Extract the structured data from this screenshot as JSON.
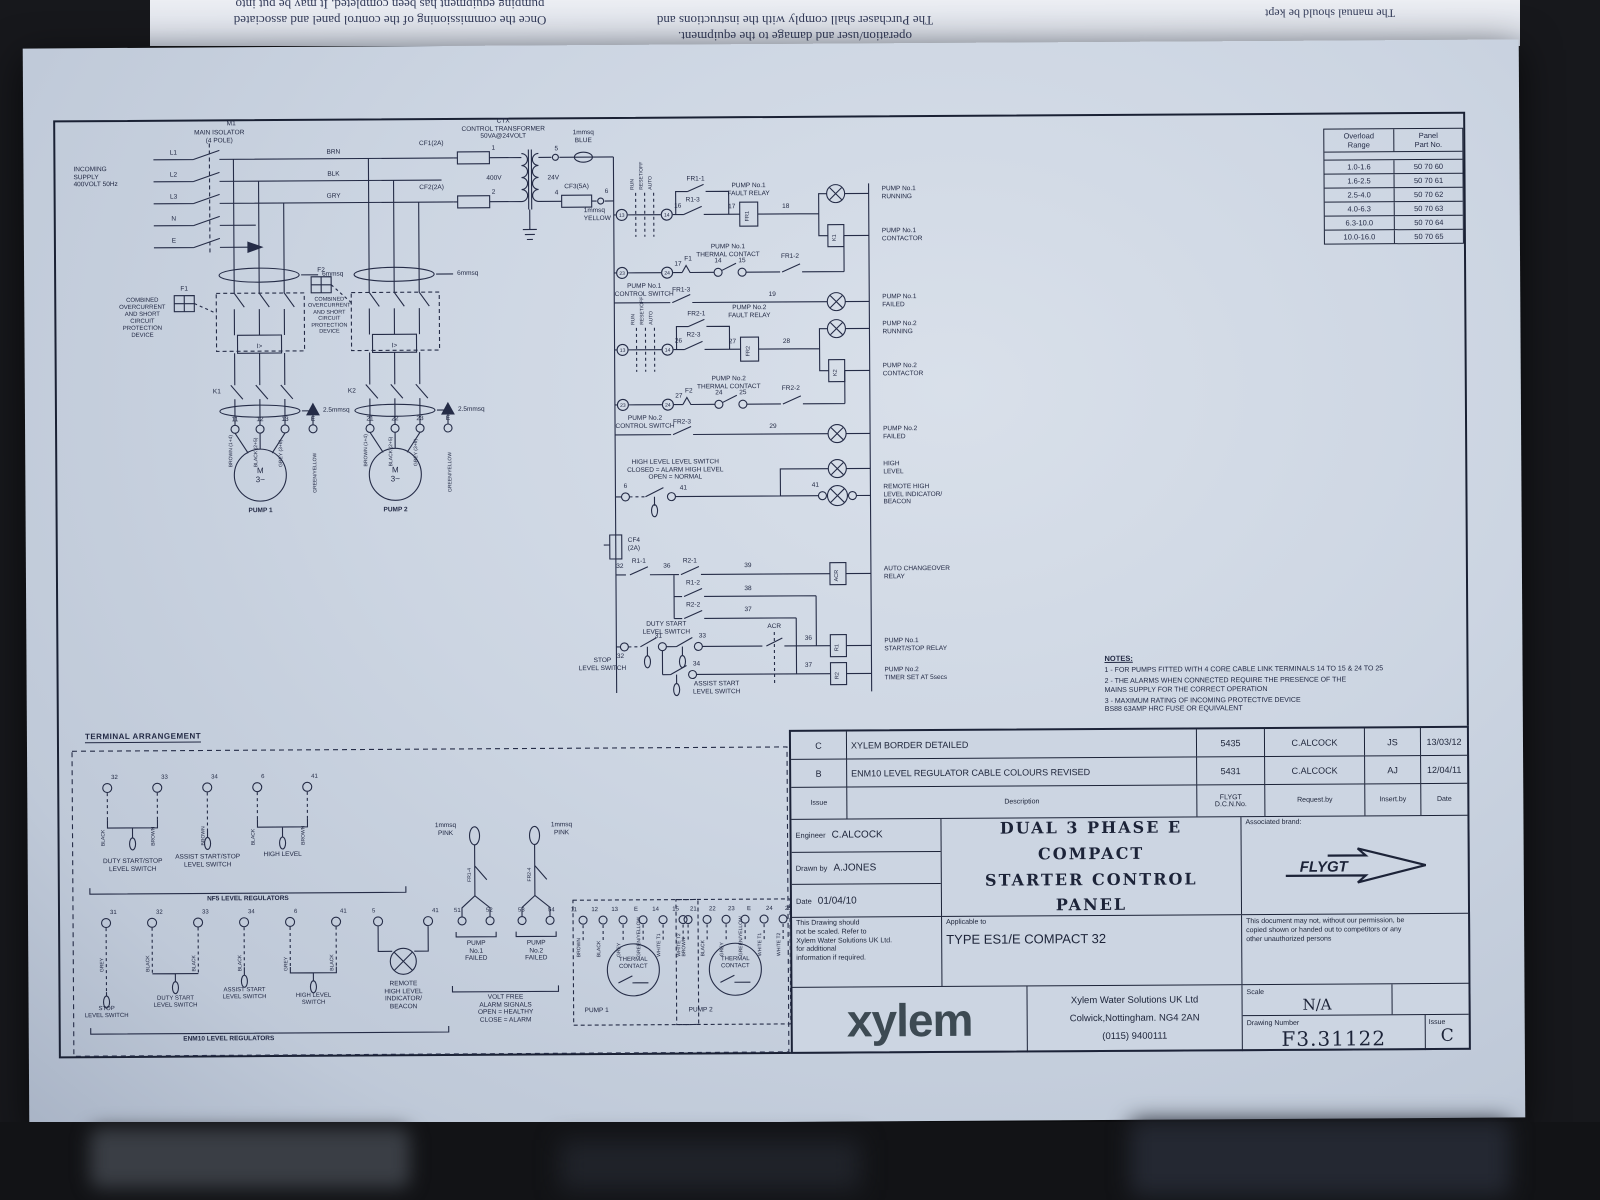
{
  "photo": {
    "flip_l1": "Once the commissioning of the control panel and associated",
    "flip_l2": "pumping equipment has been completed. It may be put into",
    "flip_c1": "operation/user and damage to the equipment.",
    "flip_c2": "The Purchaser shall comply with the instructions and",
    "flip_r1": "The manual should be kept"
  },
  "sch": {
    "m1": "M1",
    "iso": "MAIN ISOLATOR\n(4 POLE)",
    "incoming": "INCOMING\nSUPPLY\n400VOLT 50Hz",
    "l1": "L1",
    "l2": "L2",
    "l3": "L3",
    "n": "N",
    "e": "E",
    "brn": "BRN",
    "blk": "BLK",
    "gry": "GRY",
    "c6": "6mmsq",
    "c25": "2.5mmsq",
    "prot": "COMBINED\nOVERCURRENT\nAND SHORT\nCIRCUIT\nPROTECTION\nDEVICE",
    "f1": "F1",
    "f2": "F2",
    "isym": "I>",
    "k1": "K1",
    "k2": "K2",
    "motor": "M\n3~",
    "pump1": "PUMP 1",
    "pump2": "PUMP 2",
    "ctx": "CTX\nCONTROL TRANSFORMER\n50VA@24VOLT",
    "cf1": "CF1(2A)",
    "cf2": "CF2(2A)",
    "cf3": "CF3(5A)",
    "cf4": "CF4\n(2A)",
    "v400": "400V",
    "v24": "24V",
    "blue": "1mmsq\nBLUE",
    "yellow": "1mmsq\nYELLOW",
    "pink": "1mmsq\nPINK",
    "run": "RUN",
    "reset": "RESET/OFF",
    "auto": "AUTO",
    "p1ctrl": "PUMP No.1\nCONTROL SWITCH",
    "p2ctrl": "PUMP No.2\nCONTROL SWITCH",
    "fr11": "FR1-1",
    "fr12": "FR1-2",
    "fr13": "FR1-3",
    "fr14": "FR1-4",
    "fr21": "FR2-1",
    "fr22": "FR2-2",
    "fr23": "FR2-3",
    "fr24": "FR2-4",
    "r11": "R1-1",
    "r12": "R1-2",
    "r13": "R1-3",
    "r21": "R2-1",
    "r22": "R2-2",
    "r23": "R2-3",
    "fr1": "FR1",
    "fr2": "FR2",
    "acr": "ACR",
    "r1": "R1",
    "r2": "R2",
    "p1fault": "PUMP No.1\nFAULT RELAY",
    "p2fault": "PUMP No.2\nFAULT RELAY",
    "p1therm": "PUMP No.1\nTHERMAL CONTACT",
    "p2therm": "PUMP No.2\nTHERMAL CONTACT",
    "hlsw": "HIGH LEVEL LEVEL SWITCH\nCLOSED = ALARM HIGH LEVEL\nOPEN = NORMAL",
    "stopls": "STOP\nLEVEL SWITCH",
    "dutyls": "DUTY START\nLEVEL SWITCH",
    "assistls": "ASSIST START\nLEVEL SWITCH",
    "o_p1run": "PUMP No.1\nRUNNING",
    "o_p1cont": "PUMP No.1\nCONTACTOR",
    "o_p1fail": "PUMP No.1\nFAILED",
    "o_p2run": "PUMP No.2\nRUNNING",
    "o_p2cont": "PUMP No.2\nCONTACTOR",
    "o_p2fail": "PUMP No.2\nFAILED",
    "o_hl": "HIGH\nLEVEL",
    "o_remote": "REMOTE HIGH\nLEVEL INDICATOR/\nBEACON",
    "o_acr": "AUTO CHANGEOVER\nRELAY",
    "o_r1": "PUMP No.1\nSTART/STOP RELAY",
    "o_r2": "PUMP No.2\nTIMER SET AT 5secs",
    "t": {
      "1": "1",
      "2": "2",
      "4": "4",
      "5": "5",
      "6": "6",
      "11": "11",
      "12": "12",
      "13": "13",
      "14": "14",
      "15": "15",
      "16": "16",
      "17": "17",
      "18": "18",
      "19": "19",
      "21": "21",
      "22": "22",
      "23": "23",
      "24": "24",
      "25": "25",
      "26": "26",
      "27": "27",
      "28": "28",
      "29": "29",
      "31": "31",
      "32": "32",
      "33": "33",
      "34": "34",
      "36": "36",
      "37": "37",
      "38": "38",
      "39": "39",
      "41": "41",
      "51": "51",
      "52": "52",
      "53": "53",
      "54": "54",
      "E": "E"
    },
    "col": {
      "black": "BLACK",
      "brown": "BROWN",
      "grey": "GREY",
      "grnyel": "GREEN/YELLOW",
      "wt1": "WHITE T1",
      "wt2": "WHITE T2",
      "brown14": "BROWN (1+4)",
      "black25": "BLACK (2+5)",
      "grey36": "GREY (3+6)"
    }
  },
  "overload": {
    "h1": "Overload\nRange",
    "h2": "Panel\nPart No.",
    "rows": [
      [
        "1.0-1.6",
        "50 70 60"
      ],
      [
        "1.6-2.5",
        "50 70 61"
      ],
      [
        "2.5-4.0",
        "50 70 62"
      ],
      [
        "4.0-6.3",
        "50 70 63"
      ],
      [
        "6.3-10.0",
        "50 70 64"
      ],
      [
        "10.0-16.0",
        "50 70 65"
      ]
    ]
  },
  "notes": {
    "heading": "NOTES:",
    "i1": "1 - FOR PUMPS FITTED WITH 4 CORE CABLE LINK TERMINALS 14 TO 15 & 24 TO 25",
    "i2": "2 - THE ALARMS WHEN CONNECTED REQUIRE THE PRESENCE OF THE\n      MAINS SUPPLY FOR THE CORRECT OPERATION",
    "i3": "3 - MAXIMUM RATING OF INCOMING PROTECTIVE DEVICE\n      BS88 63AMP HRC FUSE OR EQUIVALENT"
  },
  "ta": {
    "heading": "TERMINAL ARRANGEMENT",
    "nf5": "NF5 LEVEL REGULATORS",
    "enm10": "ENM10 LEVEL REGULATORS",
    "dutyss": "DUTY START/STOP\nLEVEL SWITCH",
    "assistss": "ASSIST START/STOP\nLEVEL SWITCH",
    "hl": "HIGH LEVEL",
    "stopls": "STOP\nLEVEL SWITCH",
    "dutyls": "DUTY START\nLEVEL SWITCH",
    "assistls": "ASSIST START\nLEVEL SWITCH",
    "hlsw": "HIGH LEVEL\nSWITCH",
    "remote": "REMOTE\nHIGH LEVEL\nINDICATOR/\nBEACON",
    "p1f": "PUMP\nNo.1\nFAILED",
    "p2f": "PUMP\nNo.2\nFAILED",
    "vf": "VOLT FREE\nALARM SIGNALS\nOPEN = HEALTHY\nCLOSE = ALARM",
    "thermal": "THERMAL\nCONTACT",
    "pump1": "PUMP 1",
    "pump2": "PUMP 2"
  },
  "tb": {
    "rev": [
      {
        "issue": "C",
        "desc": "XYLEM BORDER DETAILED",
        "dcn": "5435",
        "req": "C.ALCOCK",
        "ins": "JS",
        "date": "13/03/12"
      },
      {
        "issue": "B",
        "desc": "ENM10 LEVEL REGULATOR CABLE COLOURS REVISED",
        "dcn": "5431",
        "req": "C.ALCOCK",
        "ins": "AJ",
        "date": "12/04/11"
      }
    ],
    "h_issue": "Issue",
    "h_desc": "Description",
    "h_dcn": "FLYGT\nD.C.N.No.",
    "h_req": "Request.by",
    "h_ins": "Insert.by",
    "h_date": "Date",
    "engineer_label": "Engineer",
    "engineer": "C.ALCOCK",
    "drawn_label": "Drawn by",
    "drawn": "A.JONES",
    "date_label": "Date",
    "date": "01/04/10",
    "title1": "DUAL 3 PHASE E COMPACT",
    "title2": "STARTER CONTROL PANEL",
    "brand_label": "Associated brand:",
    "brand": "FLYGT",
    "noscale": "This Drawing should\nnot be scaled. Refer to\nXylem Water Solutions UK Ltd.\nfor additional\ninformation if required.",
    "applicable_label": "Applicable to",
    "applicable": "TYPE ES1/E COMPACT 32",
    "permission": "This document may not, without our permission, be\ncopied shown or handed out to competitors or any\nother unauthorized persons",
    "logo": "xylem",
    "addr1": "Xylem Water Solutions UK Ltd",
    "addr2": "Colwick,Nottingham. NG4 2AN",
    "addr3": "(0115) 9400111",
    "scale_label": "Scale",
    "scale": "N/A",
    "dn_label": "Drawing Number",
    "dn": "F3.31122",
    "issue_label": "Issue",
    "issue": "C"
  }
}
